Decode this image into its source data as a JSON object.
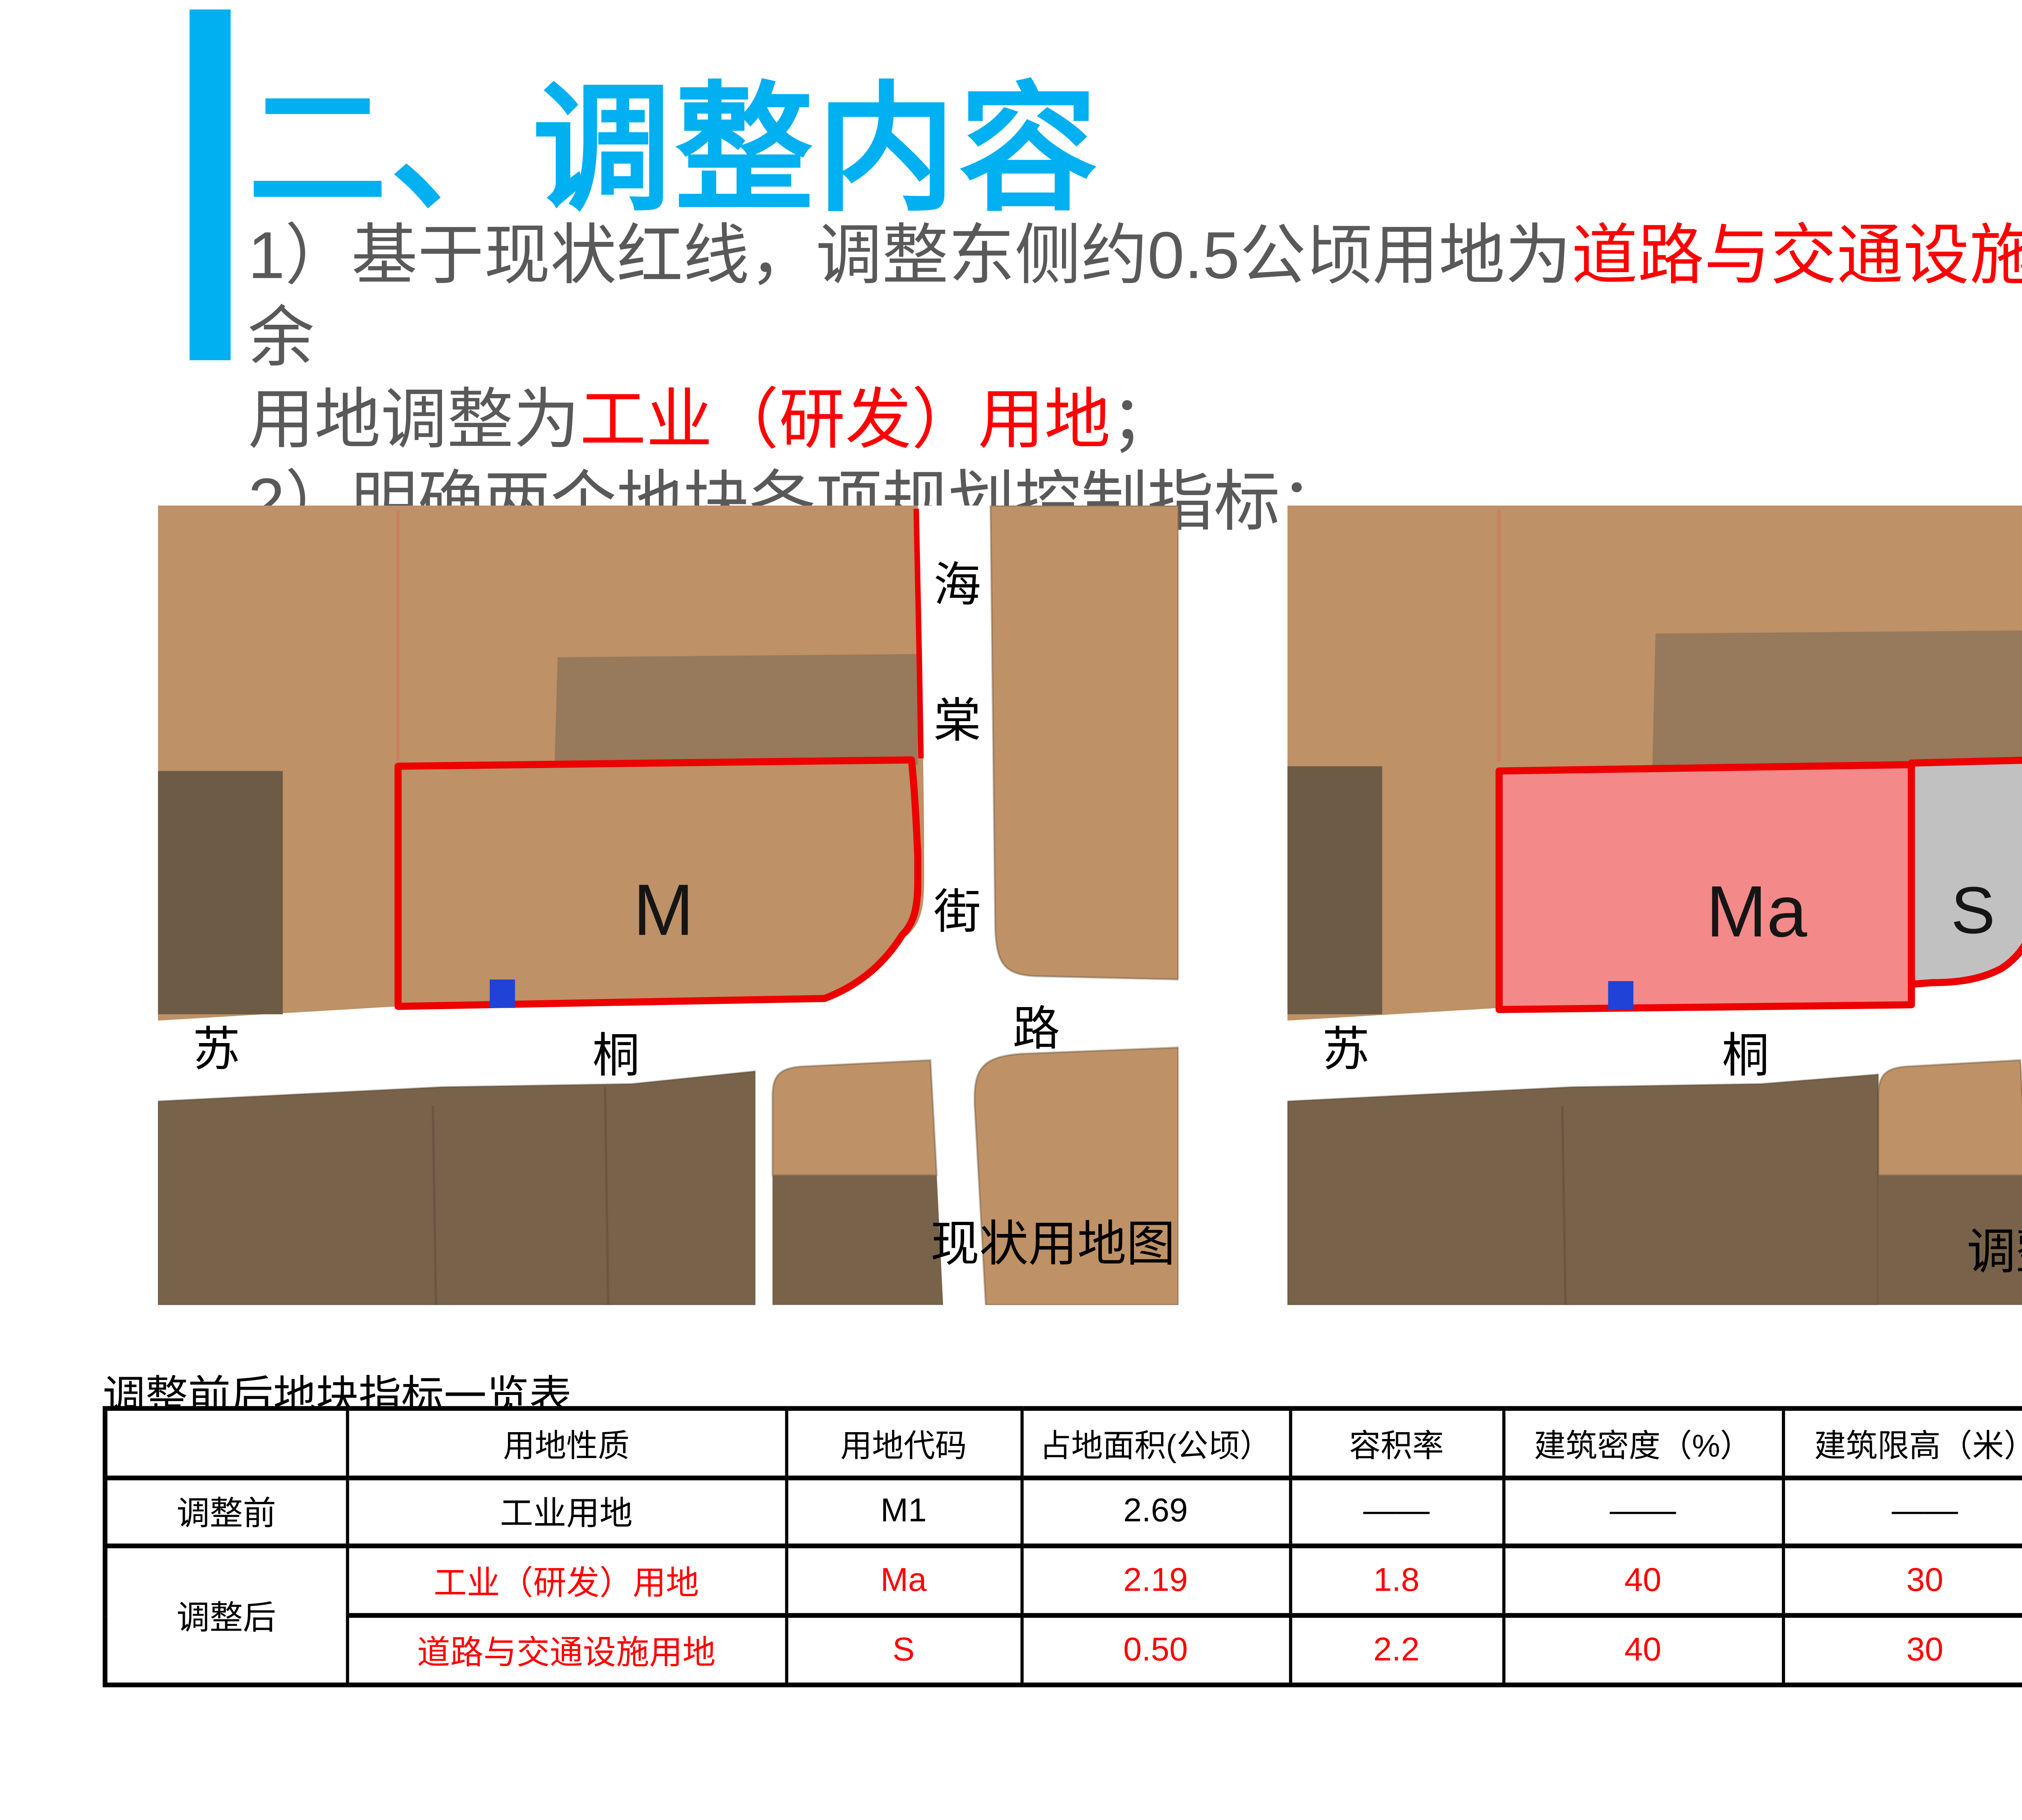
{
  "slide": {
    "title": "二、调整内容",
    "body": {
      "line1_pre": "1）基于现状红线，调整东侧约0.5公顷用地为",
      "line1_red": "道路与交通设施用地",
      "line1_post": "，其余",
      "line2_pre": "用地调整为",
      "line2_red": "工业（研发）用地",
      "line2_post": "；",
      "line3": "2）明确两个地块各项规划控制指标；"
    }
  },
  "maps": {
    "before": {
      "caption": "现状用地图",
      "parcel_label": "M",
      "vertical_road": [
        "海",
        "棠",
        "街"
      ],
      "horizontal_road": [
        "苏",
        "桐",
        "路"
      ]
    },
    "after": {
      "caption": "调整后用地图",
      "parcel_label": "Ma",
      "s_parcel_label": "S",
      "vertical_road": [
        "海",
        "棠",
        "街"
      ],
      "horizontal_road": [
        "苏",
        "桐",
        "路"
      ]
    }
  },
  "table": {
    "title": "调整前后地块指标一览表",
    "headers": [
      "",
      "用地性质",
      "用地代码",
      "占地面积(公顷）",
      "容积率",
      "建筑密度（%）",
      "建筑限高（米）",
      "绿化率（%）"
    ],
    "rows": [
      {
        "group": "调整前",
        "cells": [
          "工业用地",
          "M1",
          "2.69",
          "——",
          "——",
          "——",
          "——"
        ]
      },
      {
        "group": "调整后",
        "cells": [
          "工业（研发）用地",
          "Ma",
          "2.19",
          "1.8",
          "40",
          "30",
          "30"
        ]
      },
      {
        "group": "",
        "cells": [
          "道路与交通设施用地",
          "S",
          "0.50",
          "2.2",
          "40",
          "30",
          "15"
        ]
      }
    ]
  },
  "colors": {
    "accent_cyan": "#00B0F0",
    "body_gray": "#595959",
    "text_red": "#FF0000",
    "map_outline_red": "#EC0000",
    "map_tan": "#BE9166",
    "map_brown_mid": "#97795B",
    "map_brown_dark": "#6E5B45",
    "map_brown_deep": "#78624A",
    "parcel_pink": "#F48989",
    "parcel_gray": "#C1C1C1",
    "map_blue": "#2042D6"
  }
}
